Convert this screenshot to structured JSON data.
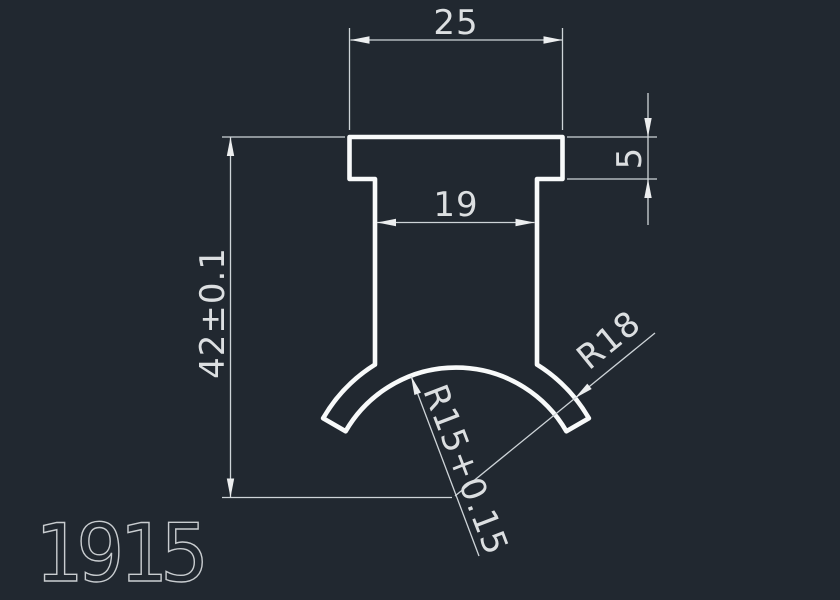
{
  "canvas": {
    "background_color": "#212830",
    "outline_color": "#F8FAFA",
    "dimension_color": "#CED4D8"
  },
  "part_number": "1915",
  "dimensions": {
    "flange_width": "25",
    "stem_width": "19",
    "flange_thickness": "5",
    "overall_height": "42±0.1",
    "outer_radius": "R18",
    "inner_radius": "R15+0.15"
  }
}
